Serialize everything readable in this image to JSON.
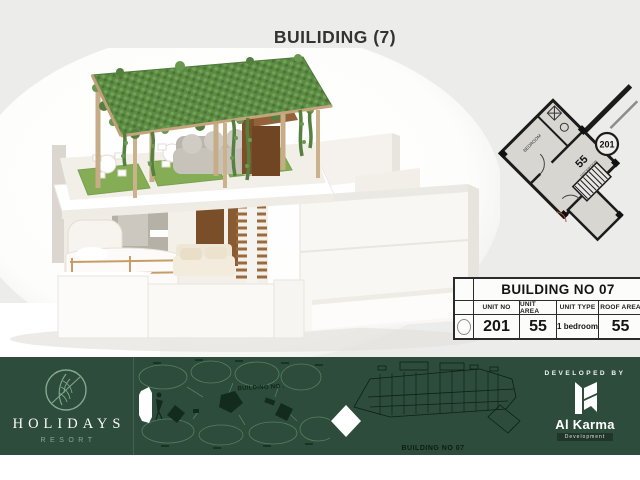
{
  "slide": {
    "title": "BUILIDING (7)"
  },
  "unit_plan": {
    "unit_circle_label": "201",
    "area_label": "55",
    "reception_label": "RECEPTION",
    "bedroom_label": "BEDROOM"
  },
  "info_table": {
    "title": "BUILDING NO 07",
    "headers": {
      "unit_no": "UNIT NO",
      "unit_area": "UNIT AREA",
      "unit_type": "UNIT TYPE",
      "roof_area": "ROOF AREA"
    },
    "values": {
      "unit_no": "201",
      "unit_area": "55",
      "unit_type": "1 bedroom",
      "roof_area": "55"
    }
  },
  "footer": {
    "brand_name": "HOLIDAYS",
    "brand_subtitle": "RESORT",
    "brand_icon": "leaf-circle-icon",
    "site_plan_label": "BUILDING NO .",
    "site_plan_marker_icon": "person-icon",
    "building_plan_label": "BUILDING NO 07",
    "developed_by_label": "DEVELOPED BY",
    "developer_name": "Al Karma",
    "developer_subtitle": "Development",
    "developer_icon": "alkarma-k-icon"
  },
  "colors": {
    "banner_green": "#2d4c3c",
    "accent_green": "#82aa8e",
    "canopy_green": "#5d8b44",
    "wood_tan": "#c6ac87",
    "table_border": "#2b2b2b"
  }
}
